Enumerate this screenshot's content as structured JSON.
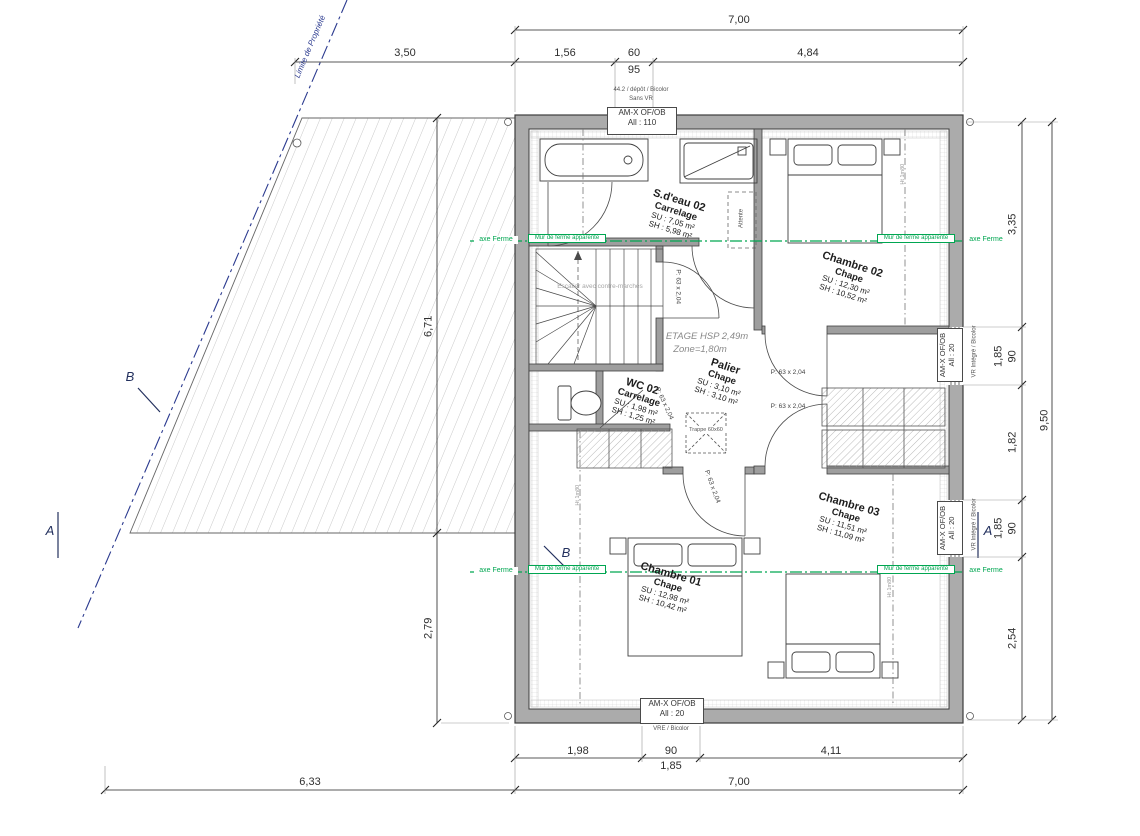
{
  "colors": {
    "wall": "#ababab",
    "line": "#3c3c3c",
    "green": "#00a651",
    "property_blue": "#2b3a8f",
    "hatch": "#c9c9c9",
    "gray_text": "#8a8a8a"
  },
  "dims": {
    "top": {
      "overall": "7,00",
      "d1": "3,50",
      "d2": "1,56",
      "d3": "60",
      "d3b": "95",
      "d4": "4,84"
    },
    "right": {
      "d1": "3,35",
      "d2": "90",
      "d2b": "1,85",
      "d3": "1,82",
      "d4": "90",
      "d4b": "1,85",
      "d5": "2,54",
      "overall": "9,50"
    },
    "bottom": {
      "d1": "1,98",
      "d2": "90",
      "d2b": "1,85",
      "d3": "4,11",
      "overall": "7,00",
      "terrace": "6,33"
    },
    "left": {
      "d1": "6,71",
      "d2": "2,79"
    }
  },
  "windows": {
    "top": {
      "pre1": "44.2 / dépôt / Bicolor",
      "pre2": "Sans VR",
      "label": "AM-X OF/OB",
      "allege": "All : 110"
    },
    "right_upper": {
      "label": "AM-X OF/OB",
      "allege": "All : 20",
      "note": "VR Intégré / Bicolor"
    },
    "right_lower": {
      "label": "AM-X OF/OB",
      "allege": "All : 20",
      "note": "VR Intégré / Bicolor"
    },
    "bottom": {
      "label": "AM-X OF/OB",
      "allege": "All : 20",
      "note": "VRE / Bicolor"
    }
  },
  "rooms": {
    "sdeau02": {
      "name": "S.d'eau 02",
      "floor": "Carrelage",
      "su": "SU : 7,05 m²",
      "sh": "SH : 5,98 m²"
    },
    "chambre02": {
      "name": "Chambre 02",
      "floor": "Chape",
      "su": "SU : 12,30 m²",
      "sh": "SH : 10,52 m²"
    },
    "palier": {
      "name": "Palier",
      "floor": "Chape",
      "su": "SU : 3,10 m²",
      "sh": "SH : 3,10 m²"
    },
    "wc02": {
      "name": "WC 02",
      "floor": "Carrelage",
      "su": "SU : 1,98 m²",
      "sh": "SH : 1,25 m²"
    },
    "chambre01": {
      "name": "Chambre 01",
      "floor": "Chape",
      "su": "SU : 12,98 m²",
      "sh": "SH : 10,42 m²"
    },
    "chambre03": {
      "name": "Chambre 03",
      "floor": "Chape",
      "su": "SU : 11,51 m²",
      "sh": "SH : 11,09 m²"
    }
  },
  "ann": {
    "etage": "ETAGE HSP 2,49m",
    "zone": "Zone=1,80m",
    "stairs": "Escalier avec contre-marches",
    "trappe": "Trappe 60x60",
    "attente": "Attente",
    "door": "P: 63 x 2,04",
    "limite": "Limite de Propriété",
    "axe": "axe Ferme",
    "mur": "Mur de ferme apparente",
    "ht": "Ht 1m80",
    "a": "A",
    "b": "B"
  }
}
